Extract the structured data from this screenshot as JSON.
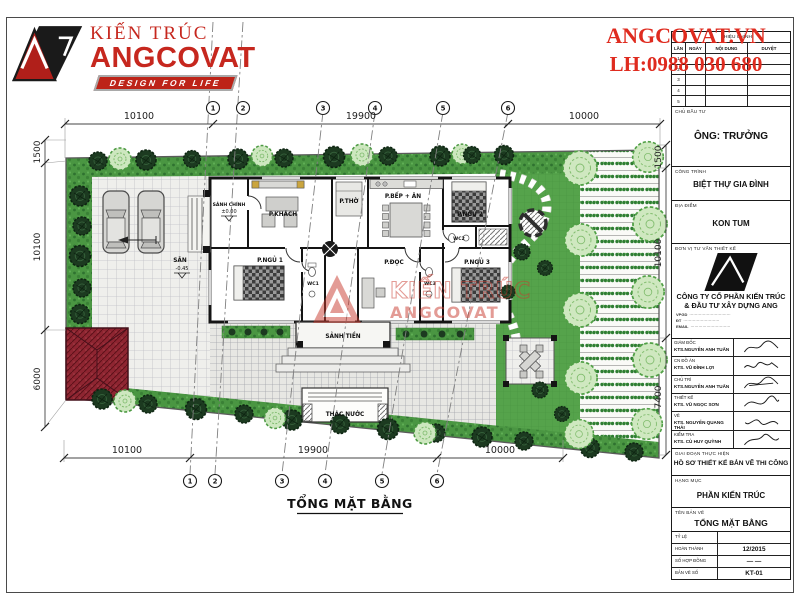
{
  "colors": {
    "brand_red": "#c6271e",
    "contact_red": "#df2b1f",
    "hedge_green": "#4a9642",
    "lawn_green": "#55a34b",
    "building_red": "#8e2531"
  },
  "header": {
    "brand_title": "KIẾN TRÚC",
    "brand_name": "ANGCOVAT",
    "brand_tagline": "DESIGN FOR LIFE",
    "contact_site": "ANGCOVAT.VN",
    "contact_phone": "LH:0988 030 680"
  },
  "titleblock": {
    "revision": {
      "title": "HIỆU CHỈNH",
      "columns": [
        "LẦN",
        "NGÀY",
        "NỘI DUNG",
        "DUYỆT"
      ],
      "rows": [
        "1",
        "2",
        "3",
        "4",
        "5"
      ]
    },
    "investor_label": "CHỦ ĐẦU TƯ",
    "investor": "ÔNG:  TRƯỞNG",
    "project_label": "CÔNG TRÌNH",
    "project": "BIỆT THỰ GIA ĐÌNH",
    "location_label": "ĐỊA ĐIỂM",
    "location": "KON TUM",
    "consultant_label": "ĐƠN VỊ TƯ VẤN THIẾT KẾ",
    "company_line1": "CÔNG TY CỔ PHẦN KIẾN TRÚC",
    "company_line2": "& ĐẦU TƯ XÂY DỰNG ANG",
    "contacts": [
      {
        "label": "VPGD",
        "value": "·······························"
      },
      {
        "label": "ĐT",
        "value": "···························"
      },
      {
        "label": "EMAIL",
        "value": "······························"
      }
    ],
    "signers": [
      {
        "role": "GIÁM ĐỐC",
        "name": "KTS.NGUYỄN ANH TUẤN"
      },
      {
        "role": "CN ĐỒ ÁN",
        "name": "KTS. VŨ ĐÌNH LỢI"
      },
      {
        "role": "CHỦ TRÌ",
        "name": "KTS.NGUYỄN ANH TUẤN"
      },
      {
        "role": "THIẾT KẾ",
        "name": "KTS. VŨ NGỌC SƠN"
      },
      {
        "role": "VẼ",
        "name": "KTS. NGUYỄN QUANG THÁI"
      },
      {
        "role": "KIỂM TRA",
        "name": "KTS. CÙ HUY QUỲNH"
      }
    ],
    "stage_label": "GIAI ĐOẠN THỰC HIỆN",
    "stage": "HỒ SƠ THIẾT KẾ BẢN VẼ THI CÔNG",
    "category_label": "HẠNG MỤC",
    "category": "PHẦN KIẾN TRÚC",
    "sheet_label": "TÊN BẢN VẼ",
    "sheet": "TỔNG MẶT BẰNG",
    "meta": [
      {
        "label": "TỶ LỆ",
        "value": ""
      },
      {
        "label": "HOÀN THÀNH",
        "value": "12/2015"
      },
      {
        "label": "SỐ HỢP ĐỒNG",
        "value": "—   —"
      },
      {
        "label": "BẢN VẼ SỐ",
        "value": "KT-01"
      }
    ]
  },
  "plan": {
    "title": "TỔNG MẶT BẰNG",
    "grid_bubbles": [
      "1",
      "2",
      "3",
      "4",
      "5",
      "6"
    ],
    "dims": {
      "top": [
        "10100",
        "19900",
        "10000"
      ],
      "bottom": [
        "10100",
        "19900",
        "10000"
      ],
      "left": [
        "1500",
        "10100",
        "6000"
      ],
      "right": [
        "1500",
        "10100",
        "7400"
      ]
    },
    "rooms": {
      "sanh_chinh": "SẢNH CHÍNH",
      "sanh_chinh_level": "±0.00",
      "khach": "P.KHÁCH",
      "tho": "P.THỜ",
      "bep_an": "P.BẾP + ĂN",
      "ngu2": "P.NGỦ 2",
      "ngu1": "P.NGỦ 1",
      "doc": "P.ĐỌC",
      "ngu3": "P.NGỦ 3",
      "wc1": "WC1",
      "wc2": "WC2",
      "wc3": "WC3",
      "sanh_tien": "SẢNH TIỀN",
      "san": "SÂN",
      "san_level": "-0.45",
      "thac_nuoc": "THÁC NƯỚC"
    },
    "watermark": {
      "line1": "KIẾN TRÚC",
      "line2": "ANGCOVAT"
    }
  }
}
